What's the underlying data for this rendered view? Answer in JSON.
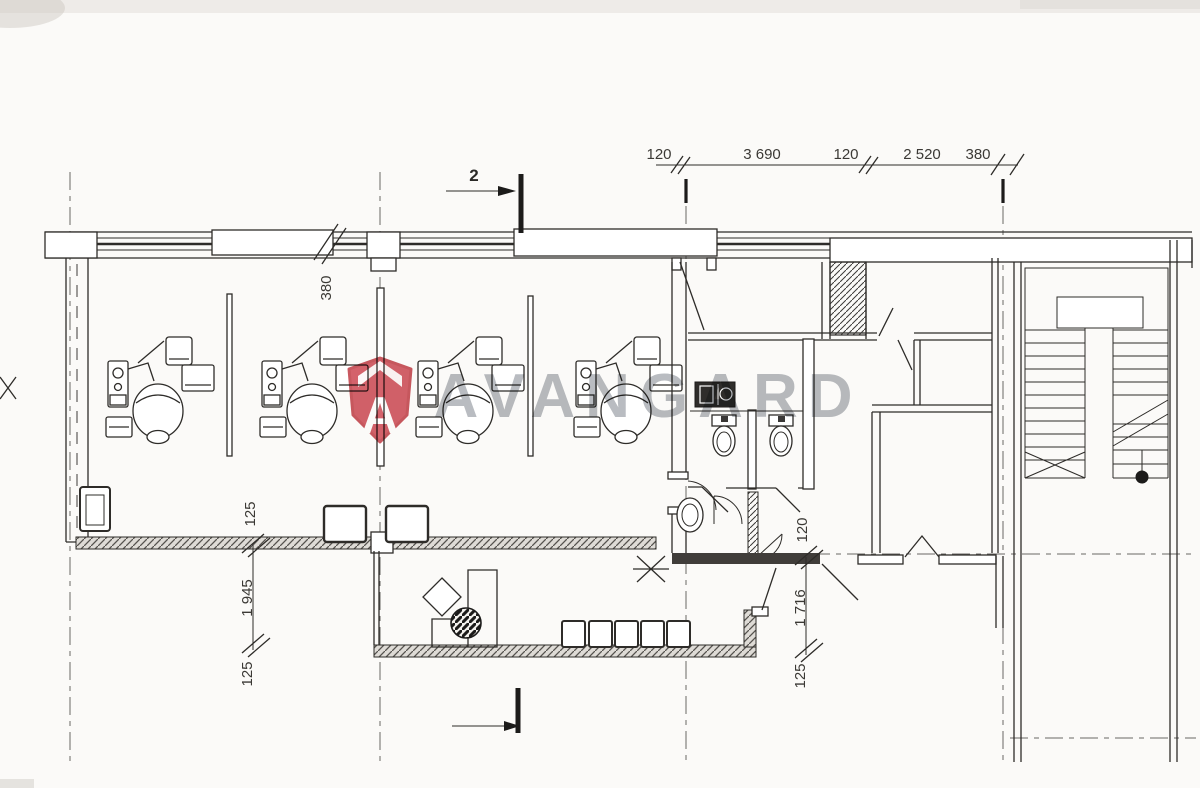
{
  "watermark": {
    "brand": "AVANGARD",
    "logo_letter": "A"
  },
  "markers": {
    "section_top": "2"
  },
  "dims": {
    "top": [
      "120",
      "3 690",
      "120",
      "2 520",
      "380"
    ],
    "wall": "380",
    "left": [
      "125",
      "1 945",
      "125"
    ],
    "right": [
      "120",
      "1 716",
      "125"
    ]
  },
  "colors": {
    "logo_red": "#d0525b",
    "watermark_gray": "#8e939b",
    "line_ink": "#2e2c29"
  }
}
